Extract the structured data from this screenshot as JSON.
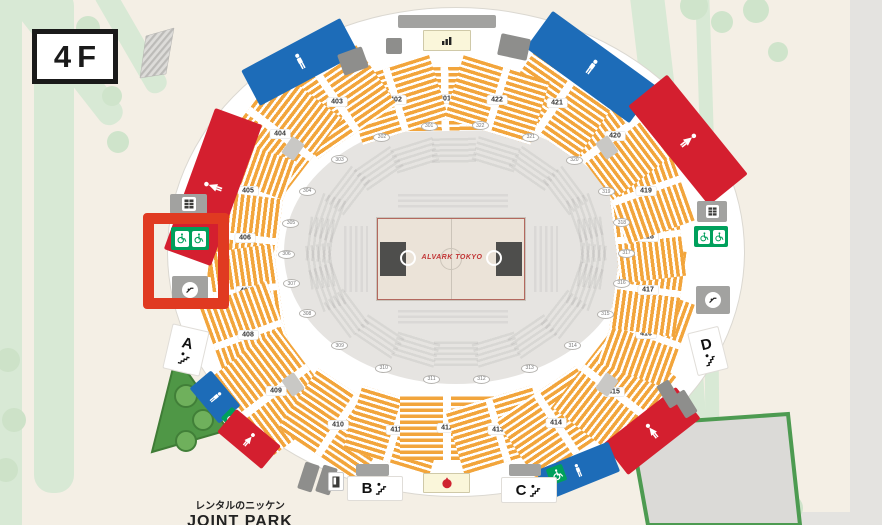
{
  "floor": {
    "label": "4F"
  },
  "park": {
    "line1": "レンタルのニッケン",
    "line2": "JOINT PARK"
  },
  "entrances": {
    "a": "A",
    "b": "B",
    "c": "C",
    "d": "D"
  },
  "court": {
    "logo": "ALVARK TOKYO"
  },
  "seating": {
    "sections": [
      "401",
      "402",
      "403",
      "404",
      "405",
      "406",
      "407",
      "408",
      "409",
      "410",
      "411",
      "412",
      "413",
      "414",
      "415",
      "416",
      "417",
      "418",
      "419",
      "420",
      "421",
      "422"
    ],
    "inner_sections": [
      "301",
      "302",
      "303",
      "304",
      "305",
      "306",
      "307",
      "308",
      "309",
      "310",
      "311",
      "312",
      "313",
      "314",
      "315",
      "316",
      "317",
      "318",
      "319",
      "320",
      "321",
      "322"
    ]
  },
  "icons": {
    "mens_restroom": "male-figure",
    "womens_restroom": "female-figure",
    "accessible_seating": "wheelchair",
    "stairs": "stairs-figure",
    "escalator": "escalator-circle",
    "lockers": "locker-grid",
    "vending": "vending-machine",
    "concession": "shop-bars",
    "food_stand": "food-red"
  },
  "colors": {
    "seat_orange": "#f2a53c",
    "restroom_blue": "#1d6cb8",
    "restroom_red": "#d41f2f",
    "accessible_green": "#00a05c",
    "highlight_red": "#e03a21",
    "park_green": "#4f9746",
    "road_green": "#d8e9d5"
  }
}
